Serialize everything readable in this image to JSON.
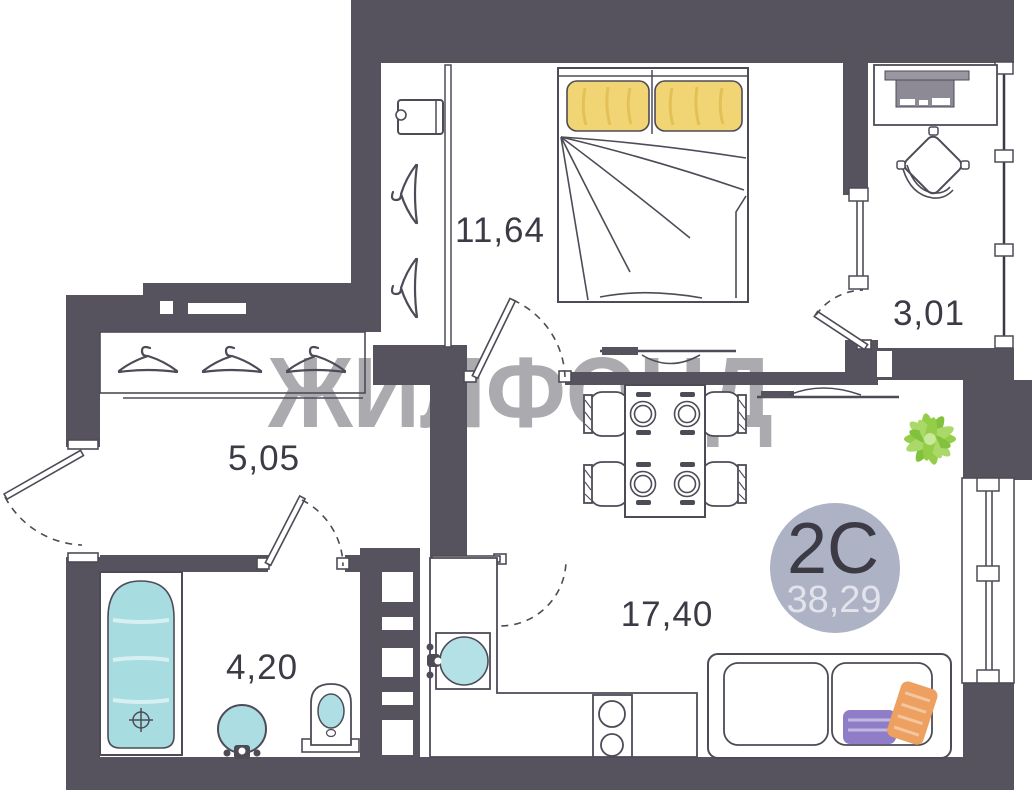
{
  "plan": {
    "watermark": "ЖИЛФОНД",
    "badge": {
      "type_label": "2C",
      "total_area": "38,29"
    },
    "rooms": [
      {
        "name": "bedroom",
        "area": "11,64"
      },
      {
        "name": "loggia",
        "area": "3,01"
      },
      {
        "name": "hallway",
        "area": "5,05"
      },
      {
        "name": "bathroom",
        "area": "4,20"
      },
      {
        "name": "living-kitchen",
        "area": "17,40"
      }
    ],
    "colors": {
      "wall": "#56525E",
      "line": "#4E4B57",
      "label_text": "#3B3A45",
      "watermark_gray": "#ABABAF",
      "badge_bg": "#ADB2C5",
      "badge_area_text": "#E3E4EB",
      "pillow_yellow": "#F1D575",
      "fixture_blue": "#A7DCE1",
      "plant_green": "#8FCB3E",
      "pillow_purple": "#8F7EC7",
      "pillow_orange": "#EDA05F"
    }
  }
}
